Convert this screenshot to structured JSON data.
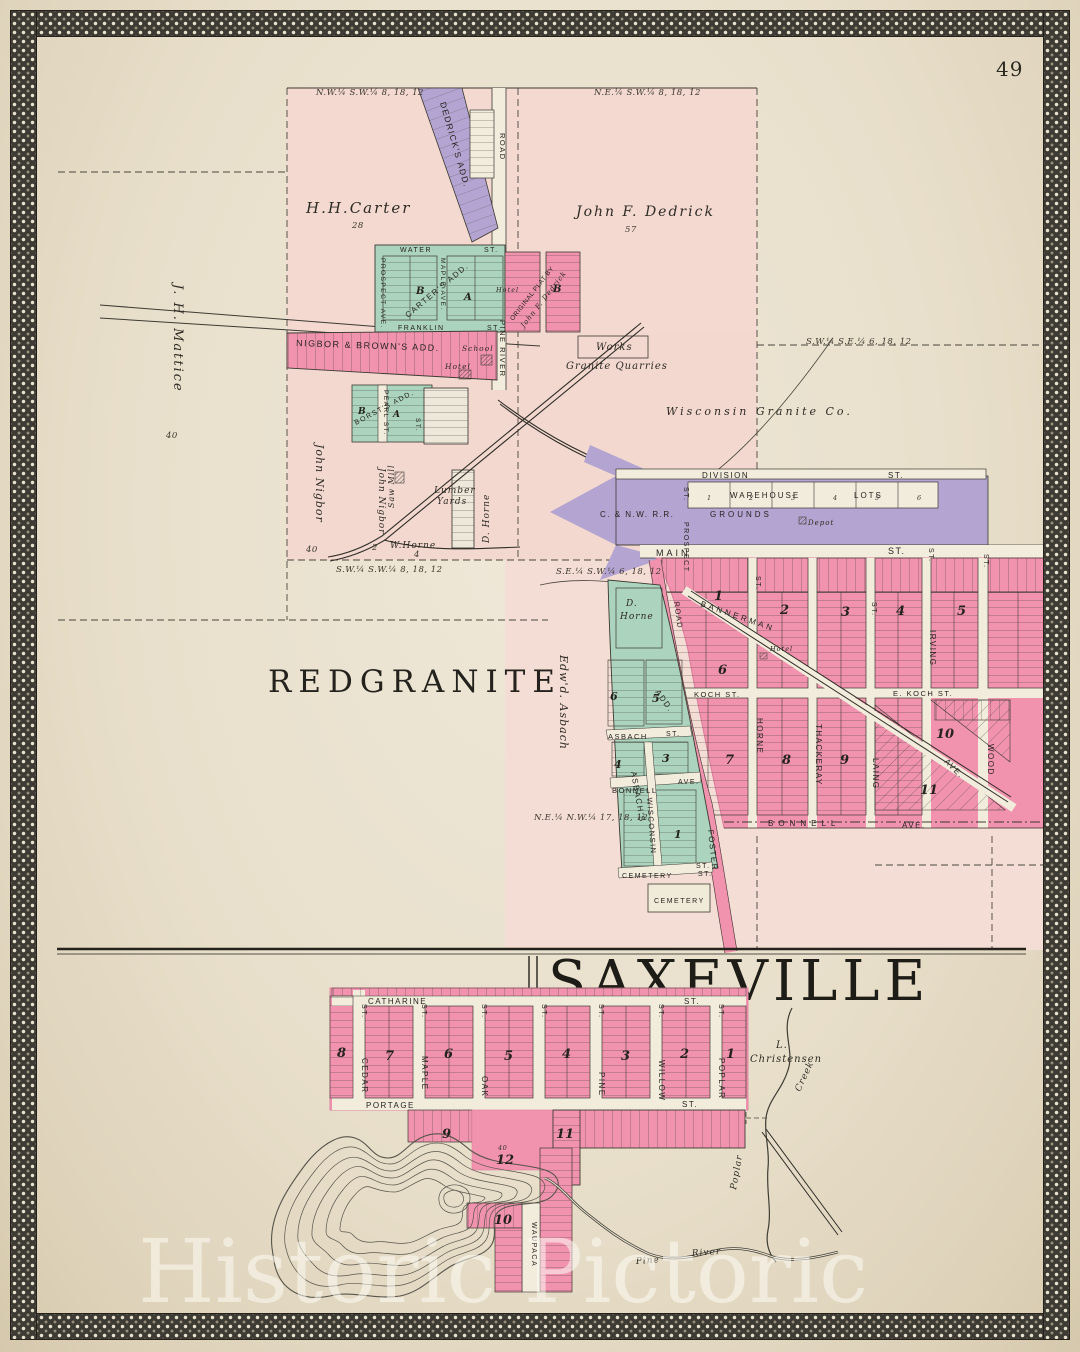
{
  "page": {
    "number": "49",
    "watermark": "Historic Pictoric"
  },
  "rg": {
    "title": "REDGRANITE",
    "sec": {
      "nw": "N.W.¼ S.W.¼ 8, 18, 12",
      "ne": "N.E.¼ S.W.¼ 8, 18, 12",
      "swse": "S.W.¼ S.E.¼ 6, 18, 12",
      "swsw": "S.W.¼ S.W.¼ 8, 18, 12",
      "sesw": "S.E.¼ S.W.¼ 6, 18, 12",
      "nenw": "N.E.¼ N.W.¼ 17, 18, 12"
    },
    "own": {
      "carter": "H.H.Carter",
      "carter_a": "28",
      "dedrick": "John F. Dedrick",
      "dedrick_a": "57",
      "mattice": "J. H. Mattice",
      "mattice_a": "40",
      "nigbor": "John Nigbor",
      "nigbor_a": "40",
      "nigbor2": "John Nigbor",
      "nigbor2_a": "2",
      "asbach": "Edw'd. Asbach",
      "dhorne": "D. Horne",
      "dhorne_d": "D.",
      "dhorne_n": "Horne",
      "whorne": "W.Horne",
      "whorne_a": "4"
    },
    "add": {
      "dedricks": "DEDRICK'S ADD.",
      "carters": "CARTER'S ADD.",
      "nigbor": "NIGBOR & BROWN'S ADD.",
      "borsts": "BORST'S ADD.",
      "orig1": "ORIGINAL PLAT BY",
      "orig2": "John F. Dedrick",
      "asbachs1": "ASBACH'S",
      "asbachs2": "ADD."
    },
    "st": {
      "water": "WATER",
      "franklin": "FRANKLIN",
      "prospect_ave": "PROSPECT AVE.",
      "maple_ave": "MAPLE AVE.",
      "pearl": "PEARL ST.",
      "st": "ST.",
      "ave": "AVE.",
      "pine_river": "PINE RIVER",
      "road": "ROAD",
      "division": "DIVISION",
      "main": "MAIN",
      "prospect": "PROSPECT",
      "bannerman": "BANNERMAN",
      "koch": "KOCH ST.",
      "ekoch": "E. KOCH ST.",
      "bonnell": "BONNELL",
      "horne": "HORNE",
      "thackeray": "THACKERAY",
      "laing": "LAING",
      "irving": "IRVING",
      "wood": "WOOD",
      "foster": "FOSTER",
      "asbach": "ASBACH",
      "wisconsin": "WISCONSIN",
      "cemetery": "CEMETERY"
    },
    "lm": {
      "school": "School",
      "hotel": "Hotel",
      "works": "Works",
      "quarries": "Granite Quarries",
      "wisgranite": "Wisconsin Granite Co.",
      "sawmill": "Saw Mill",
      "lumber1": "Lumber",
      "lumber2": "Yards",
      "depot": "Depot",
      "cemetery": "CEMETERY",
      "warehouse": "WAREHOUSE",
      "lots": "LOTS",
      "cnw": "C. & N.W. R.R.",
      "grounds": "GROUNDS"
    },
    "blk": {
      "n1": "1",
      "n2": "2",
      "n3": "3",
      "n4": "4",
      "n5": "5",
      "n6": "6",
      "n7": "7",
      "n8": "8",
      "n9": "9",
      "n10": "10",
      "n11": "11",
      "a": "A",
      "b": "B"
    },
    "wl": {
      "n1": "1",
      "n2": "2",
      "n3": "3",
      "n4": "4",
      "n5": "5",
      "n6": "6"
    }
  },
  "sx": {
    "title": "SAXEVILLE",
    "st": {
      "catharine": "CATHARINE",
      "portage": "PORTAGE",
      "st": "ST.",
      "cedar": "CEDAR",
      "maple": "MAPLE",
      "oak": "OAK",
      "pine": "PINE",
      "willow": "WILLOW",
      "poplar": "POPLAR",
      "waupaca": "WAUPACA"
    },
    "blk": {
      "n1": "1",
      "n2": "2",
      "n3": "3",
      "n4": "4",
      "n5": "5",
      "n6": "6",
      "n7": "7",
      "n8": "8",
      "n9": "9",
      "n10": "10",
      "n11": "11",
      "n12": "12",
      "b12a": "40"
    },
    "lb": {
      "li": "L.",
      "christensen": "Christensen",
      "creek": "Creek",
      "poplar": "Poplar",
      "pine": "Pine",
      "river": "River"
    }
  }
}
